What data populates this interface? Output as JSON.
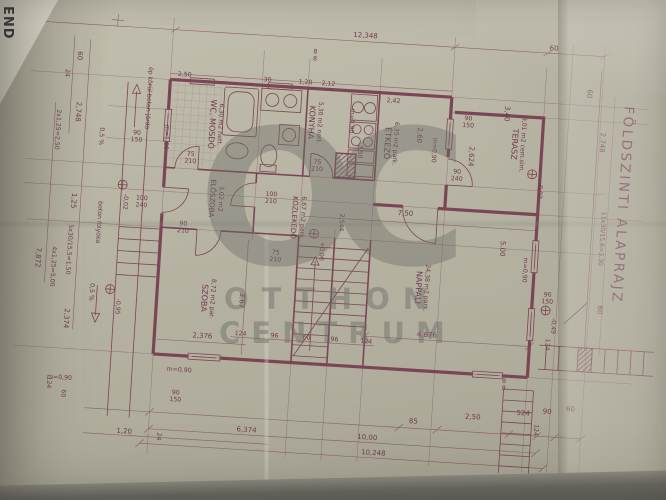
{
  "title": {
    "text": "FÖLDSZINTI ALAPRAJZ"
  },
  "corner": {
    "fragment": "END"
  },
  "watermark": {
    "monogram": "OC",
    "line1": "OTTHON",
    "line2": "CENTRUM"
  },
  "rooms": {
    "wc": {
      "name": "WC, MOSDÓ",
      "area": "6,30 m2 nett."
    },
    "konyha": {
      "name": "KONYHA",
      "area": "5,30 m2 nett."
    },
    "etkezo": {
      "name": "ÉTKEZŐ",
      "area": "6,35 m2 park."
    },
    "terasz": {
      "name": "TERASZ",
      "area": "9,01 m2 cem.sim."
    },
    "nappali": {
      "name": "NAPPALI",
      "area": "24,38 m2 park."
    },
    "szoba": {
      "name": "SZOBA",
      "area": "8,72 m2 par."
    },
    "eloszoba": {
      "name": "ELŐSZOBA",
      "area": "3,02 m2"
    },
    "kozlekedo": {
      "name": "KÖZLEKEDŐ",
      "area": "6,67 m2 park."
    }
  },
  "levels": {
    "zero": "+0,00",
    "m002": "-0,02",
    "m095": "-0,95",
    "m049": "-0,49"
  },
  "notes": {
    "walkway": "ép körül beton járda",
    "gutter": "beton folyóka",
    "slope": "0,5 %",
    "sill_090": "m=0,90",
    "sill_150": "m=1,50",
    "steps_top": "2x1,25=2,50",
    "steps_left": "5x30/15,5=1,50",
    "steps_left2": "4x1,25=5,00",
    "stair_right": "11x30/15,6=3,30"
  },
  "dims": {
    "overall_top": "12,348",
    "bottom_total": "10,00",
    "bottom_total2": "10,248",
    "d8": "8",
    "d24": "24",
    "d30": "30",
    "d60": "60",
    "d75": "75",
    "d85": "85",
    "d90": "90",
    "d96": "96",
    "d100": "100",
    "d120": "1,20",
    "d124": "124",
    "d125": "1,25",
    "d150": "150",
    "d210": "210",
    "d212": "2,12",
    "d240": "240",
    "d242": "2,42",
    "d250": "2,50",
    "d260": "2,60",
    "d340": "3,40",
    "d367": "3,67",
    "d524": "524",
    "d637": "6,374",
    "d750": "7,50",
    "d787": "7,872",
    "d2374": "2,374",
    "d2376": "2,376",
    "d2544": "2,544",
    "d2624": "2,624",
    "d2748": "2,748",
    "d4876": "4,876",
    "d500": "5,00"
  }
}
